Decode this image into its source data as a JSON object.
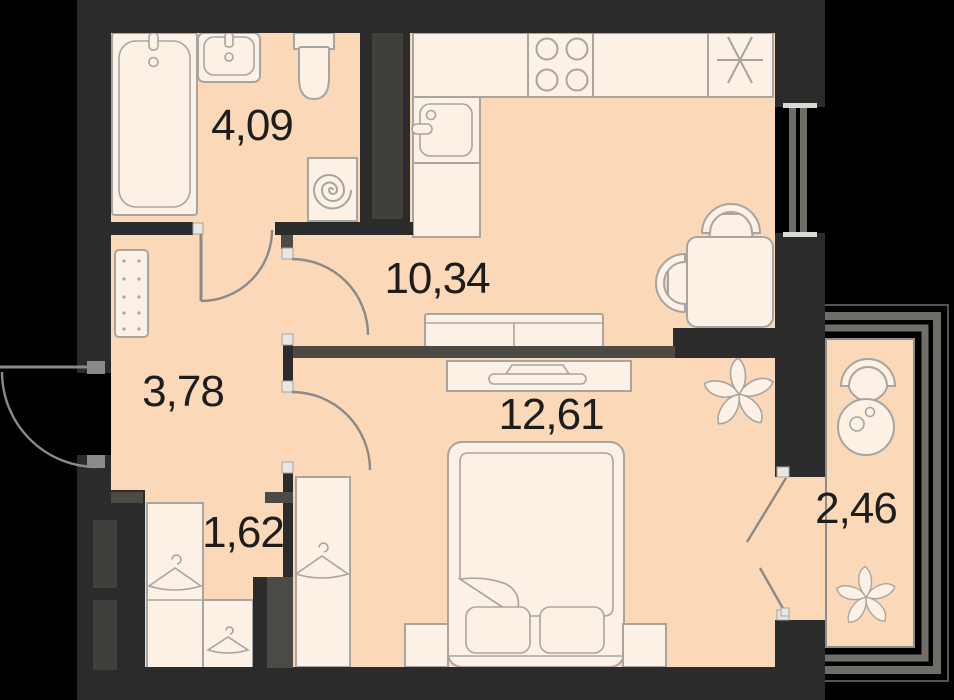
{
  "page": {
    "type": "apartment-floor-plan",
    "description": "1-room apartment plan, top view"
  },
  "colors": {
    "background": "#000000",
    "wall": "#2b2b2b",
    "partition": "#4b4a45",
    "floor": "#fbd9b8",
    "furniture": "#fcf1e4",
    "outline": "#a6a5a1",
    "door": "#8a8a86",
    "glazing": "#6e6d68",
    "label": "#1d1d1d"
  },
  "rooms": {
    "bathroom": {
      "name": "bathroom",
      "area": "4,09"
    },
    "kitchen": {
      "name": "kitchen-living",
      "area": "10,34"
    },
    "hallway": {
      "name": "hallway",
      "area": "3,78"
    },
    "bedroom": {
      "name": "bedroom",
      "area": "12,61"
    },
    "wardrobe": {
      "name": "wardrobe-niche",
      "area": "1,62"
    },
    "balcony": {
      "name": "balcony",
      "area": "2,46"
    }
  },
  "fixtures": [
    "bathtub",
    "bathroom-sink",
    "toilet",
    "washing-machine",
    "kitchen-counter",
    "stove-4-burner",
    "fridge",
    "kitchen-sink",
    "dining-table",
    "dining-chair",
    "sofa",
    "tv-stand",
    "double-bed",
    "pillow",
    "nightstand",
    "wardrobe",
    "clothes-hanger",
    "shoe-cabinet",
    "plant",
    "balcony-chair",
    "balcony-table",
    "entrance-door",
    "interior-door",
    "window",
    "balcony-glazing"
  ]
}
